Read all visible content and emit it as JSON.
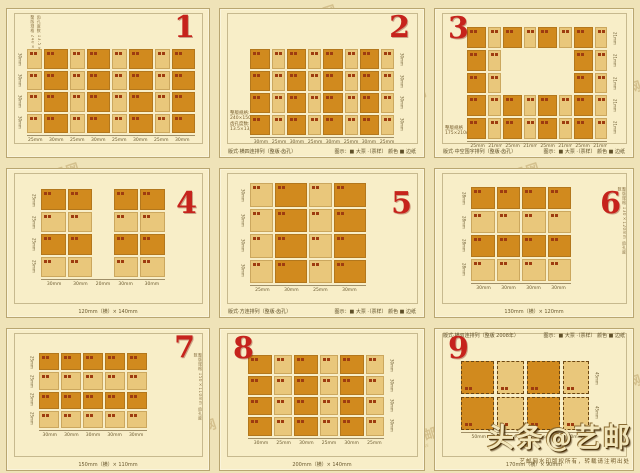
{
  "page": {
    "watermark_text": "艺邮网",
    "watermark_sub": "www",
    "brand": "头条@艺邮",
    "brand_note": "艺邮网水印版权所有，转载请注明出处"
  },
  "colors": {
    "page_bg": "#efe3b8",
    "card_bg": "#f8eec8",
    "stamp_dark": "#d18a1e",
    "stamp_light": "#e9c77b",
    "number_red": "#c6231c",
    "mark_red": "#9e3c10"
  },
  "legend_text": "图示：■ 大票 ·（票样） 颜色 ■ 边纸",
  "panels": [
    {
      "num": "1",
      "num_pos": "tr",
      "rows": 4,
      "cols": 8,
      "color_by": "col",
      "first_dark": false,
      "widths": [
        1,
        1.55,
        1,
        1.55,
        1,
        1.55,
        1,
        1.55
      ],
      "inset": {
        "top": 40,
        "right": 14,
        "bottom": 24,
        "left": 20
      },
      "ticks": [
        "25mm",
        "30mm",
        "25mm",
        "30mm",
        "25mm",
        "30mm",
        "25mm",
        "30mm"
      ],
      "side": {
        "pos": "left",
        "labels": [
          "30mm",
          "30mm",
          "30mm",
          "30mm"
        ]
      },
      "vtext": [
        "整版规格 240×150mm",
        "齿孔度数 13.5×13度"
      ],
      "vtext_pos": "tl"
    },
    {
      "num": "2",
      "num_pos": "tr",
      "rows": 4,
      "cols": 8,
      "color_by": "col",
      "first_dark": true,
      "widths": [
        1.55,
        1,
        1.55,
        1,
        1.55,
        1,
        1.55,
        1
      ],
      "inset": {
        "top": 40,
        "right": 30,
        "bottom": 22,
        "left": 30
      },
      "ticks": [
        "30mm",
        "25mm",
        "30mm",
        "25mm",
        "30mm",
        "25mm",
        "30mm",
        "25mm"
      ],
      "side": {
        "pos": "right",
        "labels": [
          "30mm",
          "30mm",
          "30mm",
          "30mm"
        ]
      },
      "info": [
        "整版规格:",
        "240×150mm",
        "齿孔度数:",
        "13.5×13度"
      ],
      "caption": {
        "pos": "bottom",
        "left": "版式·横四连排列（整版·齿孔）",
        "right": "图示：■ 大票 ·（票样） 颜色 ■ 边纸"
      }
    },
    {
      "num": "3",
      "num_pos": "tl",
      "rows": 5,
      "cols": 8,
      "color_by": "col",
      "first_dark": true,
      "widths": [
        1.55,
        1,
        1.55,
        1,
        1.55,
        1,
        1.55,
        1
      ],
      "inset": {
        "top": 18,
        "right": 26,
        "bottom": 18,
        "left": 32
      },
      "hole": {
        "rows": [
          1,
          2
        ],
        "cols": [
          2,
          3,
          4,
          5
        ]
      },
      "ticks": [
        "25mm",
        "21mm",
        "25mm",
        "21mm",
        "25mm",
        "21mm",
        "25mm",
        "21mm"
      ],
      "side": {
        "pos": "right",
        "labels": [
          "21mm",
          "21mm",
          "21mm",
          "21mm",
          "21mm"
        ]
      },
      "info": [
        "整版规格",
        "175×210mm"
      ],
      "caption": {
        "pos": "bottom",
        "left": "版式·中空围字排列（整版·齿孔）",
        "right": "图示：■ 大票 ·（票样） 颜色 ■ 边纸"
      }
    },
    {
      "num": "4",
      "num_pos": "r",
      "rows": 4,
      "cols": 5,
      "color_by": "row",
      "first_dark": true,
      "widths": [
        1.25,
        1.25,
        0.9,
        1.25,
        1.25
      ],
      "spacer_cols": [
        2
      ],
      "inset": {
        "top": 20,
        "right": 44,
        "bottom": 40,
        "left": 34
      },
      "ticks": [
        "30mm",
        "30mm",
        "20mm",
        "30mm",
        "30mm"
      ],
      "side": {
        "pos": "left",
        "labels": [
          "25mm",
          "25mm",
          "25mm",
          "25mm"
        ]
      },
      "dim": "120mm（横）× 140mm"
    },
    {
      "num": "5",
      "num_pos": "r",
      "rows": 4,
      "cols": 4,
      "color_by": "col",
      "first_dark": false,
      "widths": [
        1,
        1.35,
        1,
        1.35
      ],
      "inset": {
        "top": 14,
        "right": 58,
        "bottom": 34,
        "left": 30
      },
      "ticks": [
        "25mm",
        "30mm",
        "25mm",
        "30mm"
      ],
      "side": {
        "pos": "left",
        "labels": [
          "30mm",
          "30mm",
          "30mm",
          "30mm"
        ]
      },
      "caption": {
        "pos": "bottom",
        "left": "版式·方连排列（整版·齿孔）",
        "right": "图示：■ 大票 ·（票样） 颜色 ■ 边纸"
      },
      "dim": "130mm（横）× 120mm"
    },
    {
      "num": "6",
      "num_pos": "r",
      "rows": 4,
      "cols": 4,
      "color_by": "row",
      "first_dark": true,
      "widths": [
        1,
        1,
        1,
        1
      ],
      "inset": {
        "top": 18,
        "right": 62,
        "bottom": 36,
        "left": 36
      },
      "ticks": [
        "30mm",
        "30mm",
        "30mm",
        "30mm"
      ],
      "side": {
        "pos": "left",
        "labels": [
          "28mm",
          "28mm",
          "28mm",
          "28mm"
        ]
      },
      "vtext": [
        "整版规格 130×120mm 齿孔度数"
      ],
      "vtext_pos": "r",
      "dim": "130mm（横）× 120mm"
    },
    {
      "num": "7",
      "num_pos": "tr",
      "rows": 4,
      "cols": 5,
      "color_by": "row",
      "first_dark": true,
      "widths": [
        1,
        1,
        1,
        1,
        1
      ],
      "inset": {
        "top": 24,
        "right": 62,
        "bottom": 42,
        "left": 32
      },
      "ticks": [
        "30mm",
        "30mm",
        "30mm",
        "30mm",
        "30mm"
      ],
      "side": {
        "pos": "left",
        "labels": [
          "25mm",
          "25mm",
          "25mm",
          "25mm"
        ]
      },
      "vtext": [
        "整版规格 150×110mm 齿孔度数"
      ],
      "vtext_pos": "r",
      "dim": "150mm（横）× 110mm"
    },
    {
      "num": "8",
      "num_pos": "tl",
      "rows": 4,
      "cols": 6,
      "color_by": "col",
      "first_dark": true,
      "widths": [
        1.35,
        1,
        1.35,
        1,
        1.35,
        1
      ],
      "inset": {
        "top": 26,
        "right": 40,
        "bottom": 34,
        "left": 28
      },
      "ticks": [
        "30mm",
        "25mm",
        "30mm",
        "25mm",
        "30mm",
        "25mm"
      ],
      "side": {
        "pos": "right",
        "labels": [
          "30mm",
          "30mm",
          "30mm",
          "30mm"
        ]
      },
      "dim": "200mm（横）× 140mm"
    },
    {
      "num": "9",
      "num_pos": "tl",
      "rows": 2,
      "cols": 4,
      "color_by": "col",
      "first_dark": true,
      "dashed": true,
      "widths": [
        1.25,
        1,
        1.25,
        1
      ],
      "inset": {
        "top": 32,
        "right": 44,
        "bottom": 40,
        "left": 26
      },
      "ticks": [
        "50mm",
        "40mm",
        "50mm",
        "40mm"
      ],
      "side": {
        "pos": "right",
        "labels": [
          "45mm",
          "45mm"
        ]
      },
      "caption": {
        "pos": "top",
        "left": "版式·横双连排列（整版 2008年）",
        "right": "图示：■ 大票 ·（票样） 颜色 ■ 边纸"
      },
      "dim": "170mm（横）× 90mm"
    }
  ]
}
